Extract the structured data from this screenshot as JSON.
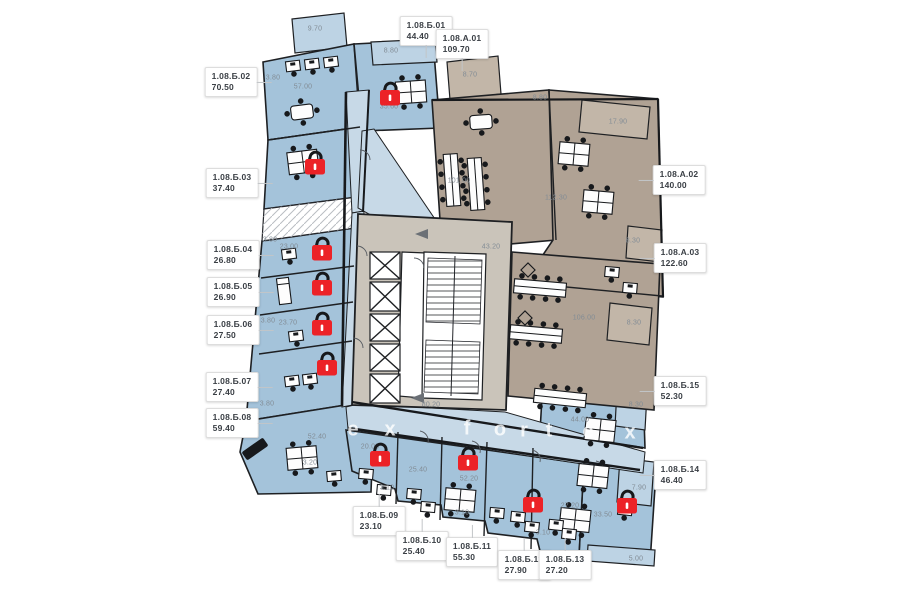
{
  "plan": {
    "name": "Floor plan level 8",
    "colors": {
      "lock_red": "#ec2227",
      "lock_shackle": "#17181b",
      "unit_blue": "#a4c3da",
      "unit_brown": "#b0a294",
      "core_gray": "#cac4ba",
      "label_text": "#3a3f45",
      "dim_text": "#828c95",
      "watermark": "#ffffff"
    },
    "unit_labels": [
      {
        "code": "1.08.Б.01",
        "area": "44.40",
        "x": 426,
        "y": 31,
        "side": "bottom"
      },
      {
        "code": "1.08.А.01",
        "area": "109.70",
        "x": 462,
        "y": 44,
        "side": "bottom"
      },
      {
        "code": "1.08.Б.02",
        "area": "70.50",
        "x": 231,
        "y": 82,
        "side": "right"
      },
      {
        "code": "1.08.Б.03",
        "area": "37.40",
        "x": 232,
        "y": 183,
        "side": "right"
      },
      {
        "code": "1.08.Б.04",
        "area": "26.80",
        "x": 233,
        "y": 255,
        "side": "right"
      },
      {
        "code": "1.08.Б.05",
        "area": "26.90",
        "x": 233,
        "y": 292,
        "side": "right"
      },
      {
        "code": "1.08.Б.06",
        "area": "27.50",
        "x": 233,
        "y": 330,
        "side": "right"
      },
      {
        "code": "1.08.Б.07",
        "area": "27.40",
        "x": 232,
        "y": 387,
        "side": "right"
      },
      {
        "code": "1.08.Б.08",
        "area": "59.40",
        "x": 232,
        "y": 423,
        "side": "right"
      },
      {
        "code": "1.08.Б.09",
        "area": "23.10",
        "x": 379,
        "y": 521,
        "side": "top"
      },
      {
        "code": "1.08.Б.10",
        "area": "25.40",
        "x": 422,
        "y": 546,
        "side": "top"
      },
      {
        "code": "1.08.Б.11",
        "area": "55.30",
        "x": 472,
        "y": 552,
        "side": "top"
      },
      {
        "code": "1.08.Б.12",
        "area": "27.90",
        "x": 524,
        "y": 565,
        "side": "top"
      },
      {
        "code": "1.08.Б.13",
        "area": "27.20",
        "x": 565,
        "y": 565,
        "side": "top"
      },
      {
        "code": "1.08.Б.14",
        "area": "46.40",
        "x": 680,
        "y": 475,
        "side": "left"
      },
      {
        "code": "1.08.Б.15",
        "area": "52.30",
        "x": 680,
        "y": 391,
        "side": "left"
      },
      {
        "code": "1.08.А.02",
        "area": "140.00",
        "x": 679,
        "y": 180,
        "side": "left"
      },
      {
        "code": "1.08.А.03",
        "area": "122.60",
        "x": 680,
        "y": 258,
        "side": "left"
      }
    ],
    "dim_labels": [
      {
        "text": "9.70",
        "x": 315,
        "y": 29
      },
      {
        "text": "8.80",
        "x": 391,
        "y": 51
      },
      {
        "text": "3.80",
        "x": 273,
        "y": 78
      },
      {
        "text": "57.00",
        "x": 303,
        "y": 87
      },
      {
        "text": "35.60",
        "x": 389,
        "y": 107
      },
      {
        "text": "8.70",
        "x": 470,
        "y": 75
      },
      {
        "text": "8.80",
        "x": 540,
        "y": 98
      },
      {
        "text": "17.90",
        "x": 618,
        "y": 122
      },
      {
        "text": "101.00",
        "x": 459,
        "y": 181
      },
      {
        "text": "112.30",
        "x": 556,
        "y": 198
      },
      {
        "text": "8.30",
        "x": 633,
        "y": 241
      },
      {
        "text": "43.20",
        "x": 491,
        "y": 247
      },
      {
        "text": "3.80",
        "x": 270,
        "y": 240
      },
      {
        "text": "23.00",
        "x": 289,
        "y": 247
      },
      {
        "text": "106.00",
        "x": 584,
        "y": 318
      },
      {
        "text": "8.30",
        "x": 634,
        "y": 323
      },
      {
        "text": "3.80",
        "x": 268,
        "y": 321
      },
      {
        "text": "23.70",
        "x": 288,
        "y": 323
      },
      {
        "text": "3.80",
        "x": 267,
        "y": 404
      },
      {
        "text": "8.30",
        "x": 636,
        "y": 405
      },
      {
        "text": "44.00",
        "x": 580,
        "y": 420
      },
      {
        "text": "80.20",
        "x": 431,
        "y": 405
      },
      {
        "text": "52.40",
        "x": 317,
        "y": 437
      },
      {
        "text": "20.00",
        "x": 370,
        "y": 447
      },
      {
        "text": "3.20",
        "x": 310,
        "y": 463
      },
      {
        "text": "25.40",
        "x": 418,
        "y": 470
      },
      {
        "text": "52.20",
        "x": 469,
        "y": 479
      },
      {
        "text": "3.10",
        "x": 387,
        "y": 488
      },
      {
        "text": "3.10",
        "x": 462,
        "y": 513
      },
      {
        "text": "27.20",
        "x": 570,
        "y": 506
      },
      {
        "text": "33.50",
        "x": 603,
        "y": 515
      },
      {
        "text": "3.10",
        "x": 543,
        "y": 533
      },
      {
        "text": "7.90",
        "x": 639,
        "y": 488
      },
      {
        "text": "5.00",
        "x": 636,
        "y": 559
      }
    ],
    "locks": [
      {
        "x": 390,
        "y": 95
      },
      {
        "x": 315,
        "y": 164
      },
      {
        "x": 322,
        "y": 250
      },
      {
        "x": 322,
        "y": 285
      },
      {
        "x": 322,
        "y": 325
      },
      {
        "x": 327,
        "y": 365
      },
      {
        "x": 380,
        "y": 456
      },
      {
        "x": 468,
        "y": 460
      },
      {
        "x": 533,
        "y": 502
      },
      {
        "x": 627,
        "y": 503
      }
    ],
    "watermark_letters": [
      {
        "ch": "e",
        "x": 353,
        "y": 430
      },
      {
        "ch": "x",
        "x": 390,
        "y": 430
      },
      {
        "ch": "f",
        "x": 467,
        "y": 429
      },
      {
        "ch": "o",
        "x": 500,
        "y": 430
      },
      {
        "ch": "r",
        "x": 524,
        "y": 431
      },
      {
        "ch": "t",
        "x": 549,
        "y": 431
      },
      {
        "ch": "e",
        "x": 588,
        "y": 432
      },
      {
        "ch": "x",
        "x": 630,
        "y": 433
      }
    ]
  }
}
